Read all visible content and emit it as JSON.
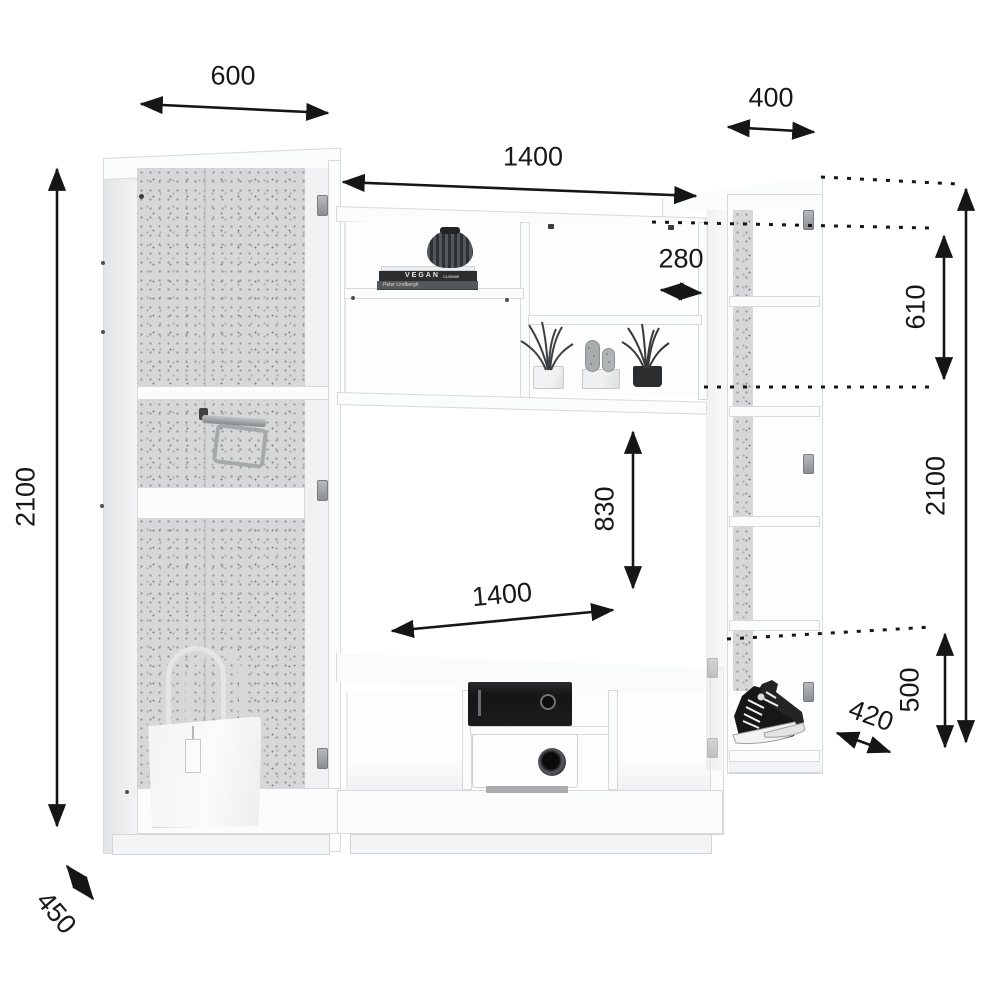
{
  "diagram": {
    "kind": "furniture-dimension-drawing",
    "units": "mm",
    "dimensions": {
      "left_cabinet_width": "600",
      "right_cabinet_width": "400",
      "center_span_width": "1400",
      "shelf_depth": "280",
      "hutch_height": "610",
      "right_total_height": "2100",
      "left_total_height": "2100",
      "tv_opening_height": "830",
      "tv_opening_width": "1400",
      "lower_right_height": "500",
      "right_cabinet_depth": "420",
      "left_cabinet_depth": "450"
    },
    "decor": {
      "book_top_title": "VEGAN",
      "book_top_subtitle": "CUISINE",
      "book_second_author": "Peter Lindbergh",
      "items": [
        "vase",
        "books",
        "potted-grass",
        "cactus",
        "handbag",
        "sneakers",
        "media-player",
        "projector",
        "pull-out-hanger"
      ]
    },
    "colors": {
      "line": "#181818",
      "carcass": "#fbfcfc",
      "back_panel": "#d5d7d8"
    }
  }
}
